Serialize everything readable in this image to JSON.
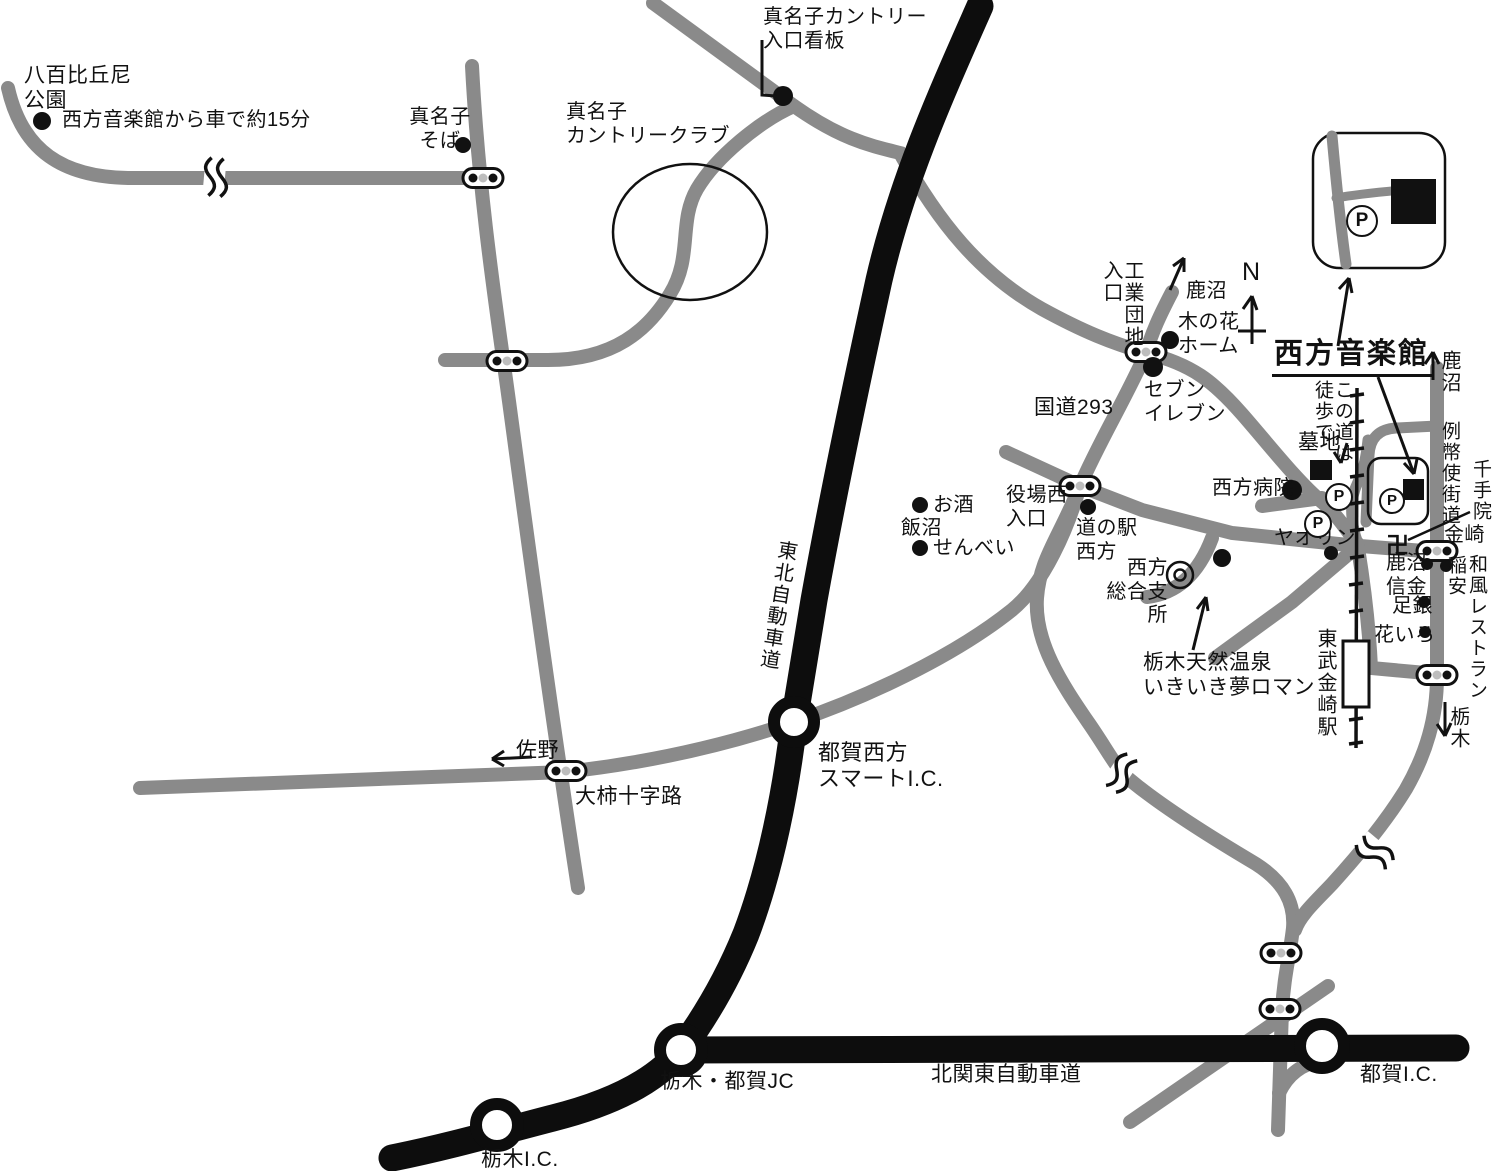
{
  "map_symbols": {
    "parking_p": "P",
    "manji": "卍",
    "north": "N"
  },
  "labels": {
    "yaobikuni": {
      "text": "八百比丘尼\n公園"
    },
    "drive15": {
      "text": "西方音楽館から車で約15分"
    },
    "manako_soba": {
      "text": "真名子\nそば"
    },
    "cc_sign": {
      "text": "真名子カントリー\n入口看板"
    },
    "cc": {
      "text": "真名子\nカントリークラブ"
    },
    "kokudo293": {
      "text": "国道293"
    },
    "kogyo": {
      "text": "工業団地\n入口"
    },
    "kanuma_top": {
      "text": "鹿沼"
    },
    "konohana": {
      "text": "木の花\nホーム"
    },
    "seven": {
      "text": "セブン\nイレブン"
    },
    "title": {
      "text": "西方音楽館"
    },
    "kanuma_right": {
      "text": "鹿沼"
    },
    "reiheishi": {
      "text": "例幣使街道"
    },
    "konomichi": {
      "text": "この道は\n徒歩で"
    },
    "bochi": {
      "text": "墓地"
    },
    "byoin": {
      "text": "西方病院"
    },
    "yaorin": {
      "text": "ヤオリン"
    },
    "senjuin": {
      "text": "千手院"
    },
    "kanasaki": {
      "text": "金崎"
    },
    "shinkin": {
      "text": "鹿沼\n信金"
    },
    "inayasu": {
      "text": "稲安"
    },
    "wafu": {
      "text": "和風レストラン"
    },
    "ashigin": {
      "text": "足銀"
    },
    "hanairo": {
      "text": "花いろ"
    },
    "tobu_station": {
      "text": "東武金崎駅"
    },
    "tochigi_right": {
      "text": "栃木"
    },
    "yakuba": {
      "text": "役場西\n入口"
    },
    "michinoeki": {
      "text": "道の駅\n西方"
    },
    "shisho": {
      "text": "西方\n総合支所"
    },
    "onsen": {
      "text": "栃木天然温泉\nいきいき夢ロマン"
    },
    "osake": {
      "text": "お酒"
    },
    "iinuma": {
      "text": "飯沼"
    },
    "senbei": {
      "text": "せんべい"
    },
    "sano": {
      "text": "佐野"
    },
    "ogaki": {
      "text": "大柿十字路"
    },
    "smart_ic": {
      "text": "都賀西方\nスマートI.C."
    },
    "tohoku_expwy": {
      "text": "東北自動車道"
    },
    "tochigi_tsuga_jc": {
      "text": "栃木・都賀JC"
    },
    "kitakanto": {
      "text": "北関東自動車道"
    },
    "tsuga_ic": {
      "text": "都賀I.C."
    },
    "tochigi_ic": {
      "text": "栃木I.C."
    }
  },
  "colors": {
    "road_gray": "#8a8a8a",
    "road_black": "#0d0d0d",
    "background": "#ffffff"
  }
}
